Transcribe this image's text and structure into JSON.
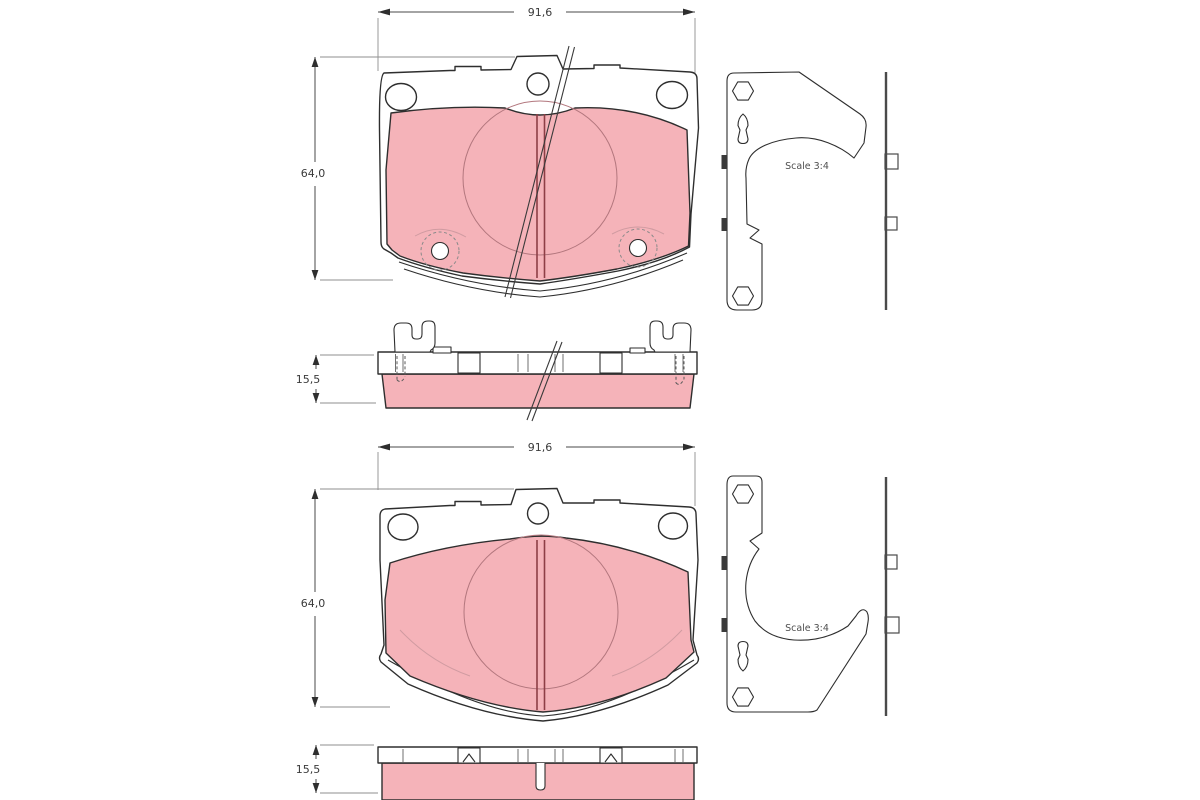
{
  "drawing": {
    "top_assembly": {
      "width": "91,6",
      "height": "64,0",
      "thickness": "15,5",
      "scale_note": "Scale 3:4"
    },
    "bottom_assembly": {
      "width": "91,6",
      "height": "64,0",
      "thickness": "15,5",
      "scale_note": "Scale 3:4"
    },
    "colors": {
      "friction_material": "#f5b3b9",
      "outline": "#2e2e2e",
      "slot": "#8e3e46",
      "contact_circle": "#b2767d",
      "dimension": "#4a4a4a",
      "background": "#ffffff"
    }
  }
}
